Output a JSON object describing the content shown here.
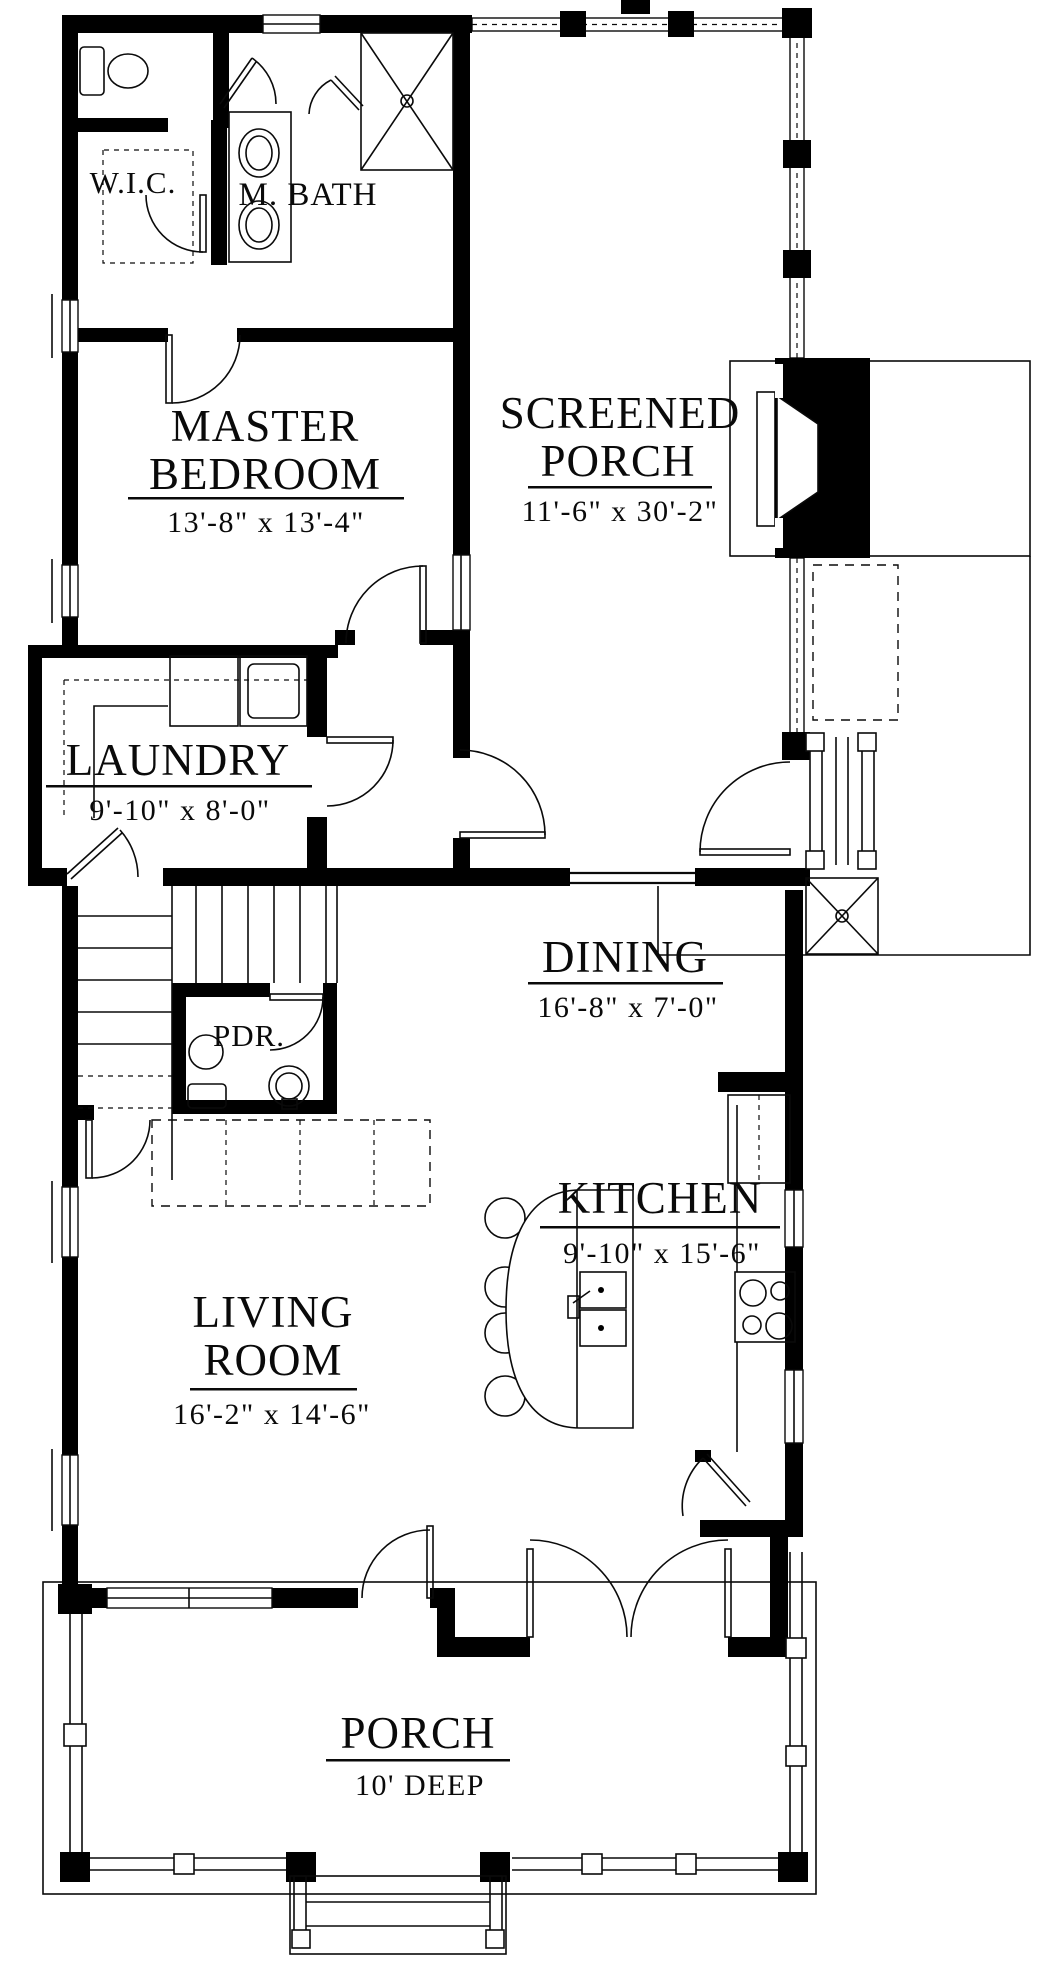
{
  "drawing": {
    "type": "first-floor-plan",
    "colors": {
      "wall": "#000000",
      "background": "#ffffff",
      "line": "#0a0a0a"
    }
  },
  "rooms": {
    "wic": {
      "label": "W.I.C."
    },
    "master_bath": {
      "label": "M. BATH"
    },
    "master_bedroom": {
      "label_line1": "MASTER",
      "label_line2": "BEDROOM",
      "dimensions": "13'-8\" x 13'-4\""
    },
    "screened_porch": {
      "label_line1": "SCREENED",
      "label_line2": "PORCH",
      "dimensions": "11'-6\" x 30'-2\""
    },
    "laundry": {
      "label": "LAUNDRY",
      "dimensions": "9'-10\" x 8'-0\""
    },
    "dining": {
      "label": "DINING",
      "dimensions": "16'-8\" x 7'-0\""
    },
    "powder_room": {
      "label": "PDR."
    },
    "kitchen": {
      "label": "KITCHEN",
      "dimensions": "9'-10\" x 15'-6\""
    },
    "living_room": {
      "label_line1": "LIVING",
      "label_line2": "ROOM",
      "dimensions": "16'-2\" x 14'-6\""
    },
    "front_porch": {
      "label": "PORCH",
      "dimensions": "10' DEEP"
    }
  }
}
